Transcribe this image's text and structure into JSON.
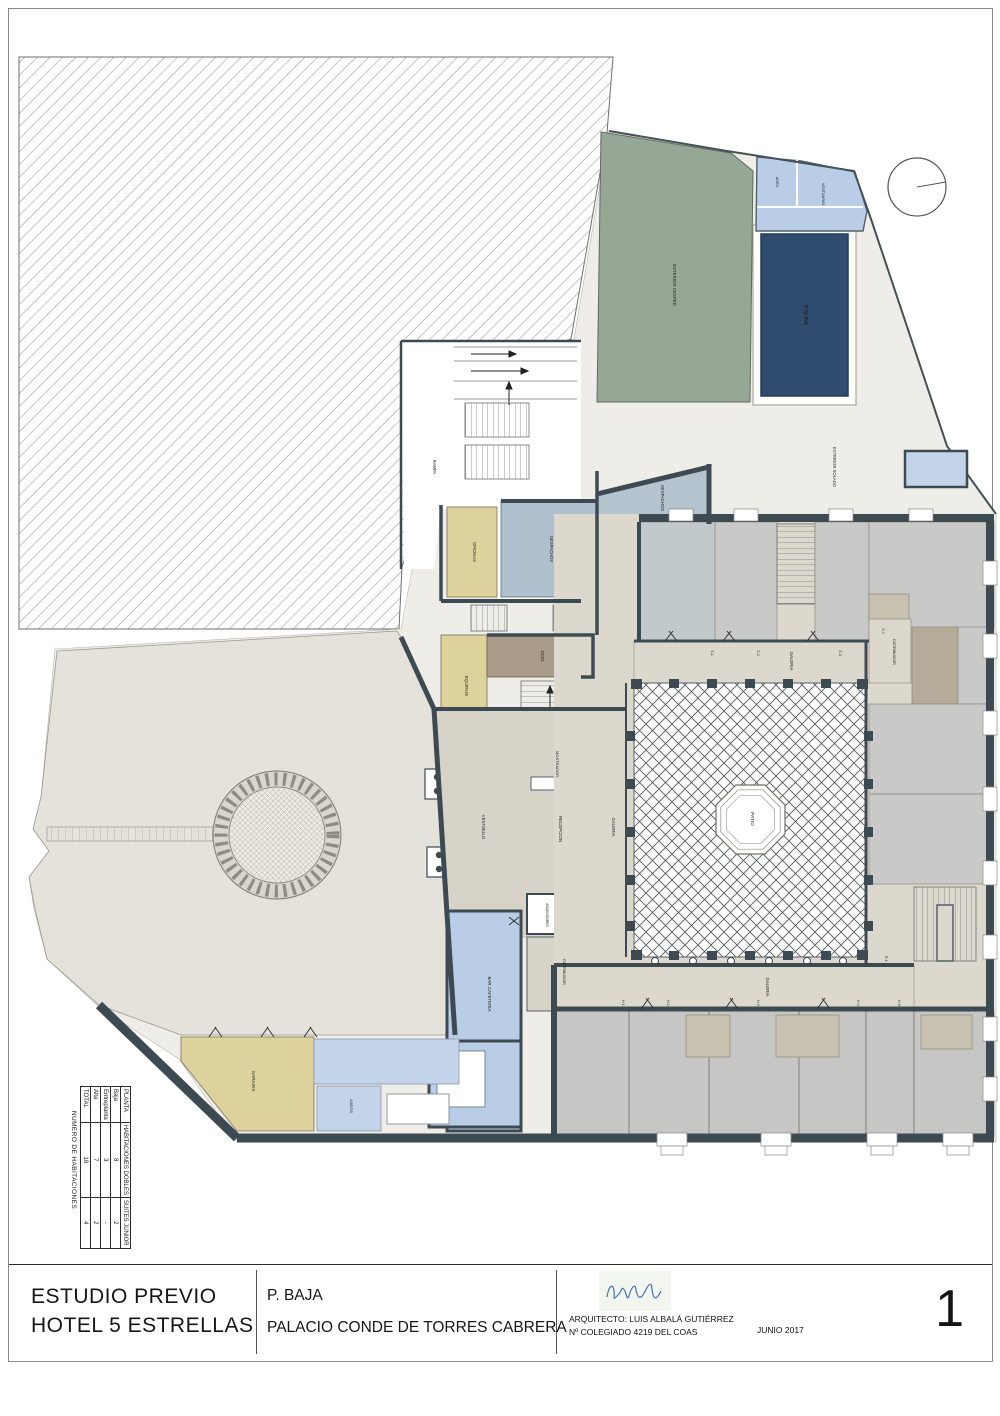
{
  "sheet": {
    "number": "1"
  },
  "title_block": {
    "project_line1": "ESTUDIO PREVIO",
    "project_line2": "HOTEL 5 ESTRELLAS",
    "plan_name": "P. BAJA",
    "building": "PALACIO CONDE DE TORRES CABRERA",
    "architect": "ARQUITECTO: LUIS ALBALÁ GUTIÉRREZ",
    "license": "Nº COLEGIADO 4219  DEL COAS",
    "date": "JUNIO 2017"
  },
  "rooms_table": {
    "title": "NUMERO DE HABITACIONES",
    "columns": [
      "PLANTA",
      "HABITACIONES DOBLES",
      "SUITES JUNIOR"
    ],
    "rows": [
      {
        "planta": "Baja",
        "dobles": "8",
        "suites": "2"
      },
      {
        "planta": "Entreplanta",
        "dobles": "3",
        "suites": "-"
      },
      {
        "planta": "Alta",
        "dobles": "7",
        "suites": "2"
      },
      {
        "planta": "TOTAL",
        "dobles": "18",
        "suites": "4"
      }
    ]
  },
  "plan": {
    "rooms": {
      "piscina": "PISCINA",
      "cesped": "EXTERIOR CESPED",
      "aseo": "ASEO",
      "vestuario": "VESTUARIO",
      "exterior_solado": "EXTERIOR SOLADO",
      "rampa": "RAMPA",
      "oficinas": "OFICINAS",
      "despachos_oeste": "DESPACHOS",
      "despachos_norte": "DESPACHOS",
      "ocio": "OCIO",
      "equipaje": "EQUIPAJE",
      "mostrador": "MOSTRADOR",
      "vestibulo": "VESTIBULO",
      "recepcion": "RECEPCION",
      "galeria_oeste": "GALERIA",
      "galeria_norte": "GALERIA",
      "galeria_sur": "GALERIA",
      "patio": "PATIO",
      "distribuidor_este": "DISTRIBUIDOR",
      "distribuidor": "DISTRIBUIDOR",
      "ascensores": "ASCENSORES",
      "bar_cafeteria": "BAR CAFETERIA",
      "garajes": "GARAJES",
      "aseos": "ASEOS"
    },
    "tags": {
      "s1": "S.1",
      "s2": "S.2",
      "s3": "S.3",
      "s4": "S.4",
      "e1": "E.1",
      "h1": "H.1",
      "h2": "H.2",
      "h3": "H.3",
      "h4": "H.4",
      "h5": "H.5"
    }
  }
}
